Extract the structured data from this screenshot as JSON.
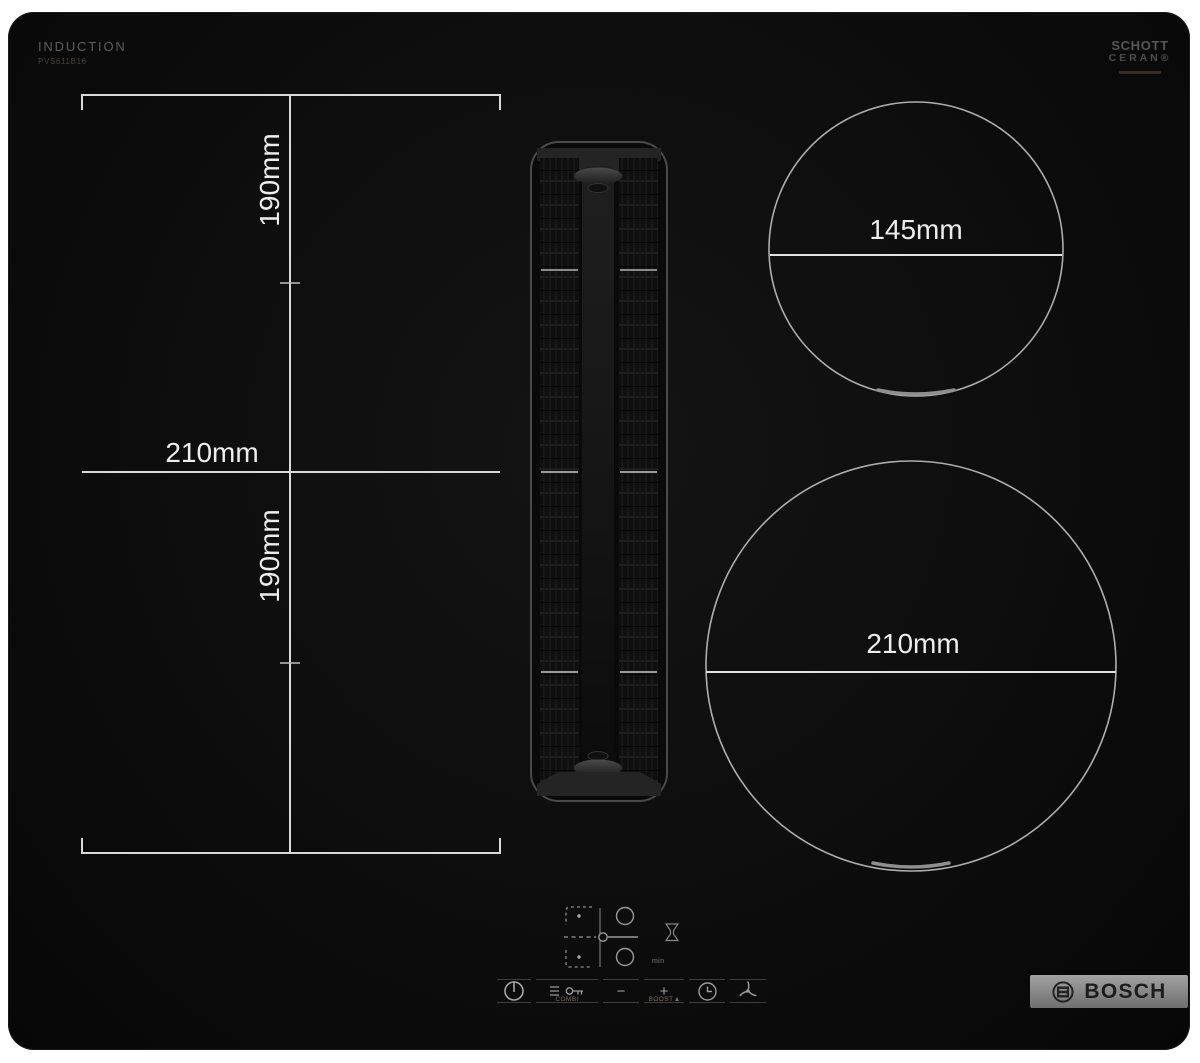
{
  "product": {
    "type_label": "INDUCTION",
    "model_number": "PVS611B16",
    "glass_logo_line1": "SCHOTT",
    "glass_logo_line2": "CERAN®"
  },
  "dimension_labels": {
    "left_rear": "190mm",
    "left_width": "210mm",
    "left_front": "190mm",
    "right_rear_diameter": "145mm",
    "right_front_diameter": "210mm"
  },
  "control_panel": {
    "combi_label": "COMBI",
    "minus_symbol": "−",
    "plus_symbol": "+",
    "boost_label": "BOOST",
    "min_label": "min",
    "icons": {
      "power": "power-icon",
      "child_lock": "key-icon",
      "fan_levels": "fan-level-bars-icon",
      "timer": "clock-icon",
      "ventilation": "fan-icon",
      "filter": "grease-filter-icon"
    }
  },
  "brand": {
    "badge_text": "BOSCH",
    "emblem": "bosch-armature-icon"
  },
  "colors": {
    "surface": "#0c0c0c",
    "dimension_line": "#d9d9d9",
    "dimension_text": "#ededed",
    "muted_print": "#9a9a9a",
    "badge_metal": "#8f8f8f",
    "badge_text": "#1d1d1d"
  }
}
